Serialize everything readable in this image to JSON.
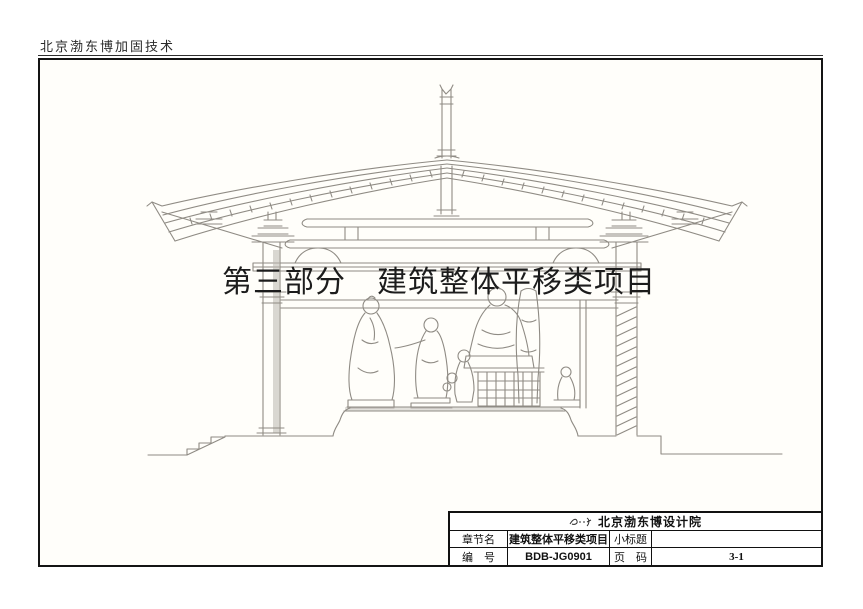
{
  "page": {
    "header_text": "北京渤东博加固技术",
    "overlay_title": "第三部分　建筑整体平移类项目"
  },
  "title_block": {
    "company": "北京渤东博设计院",
    "logo_icon": "signature-scribble-icon",
    "row1": {
      "label_a": "章节名",
      "value_a": "建筑整体平移类项目",
      "label_b": "小标题",
      "value_b": ""
    },
    "row2": {
      "label_a": "编　号",
      "value_a": "BDB-JG0901",
      "label_b": "页　码",
      "value_b": "3-1"
    }
  },
  "drawing": {
    "subject": "temple-hall-cross-section",
    "line_color": "#8f8b84"
  }
}
